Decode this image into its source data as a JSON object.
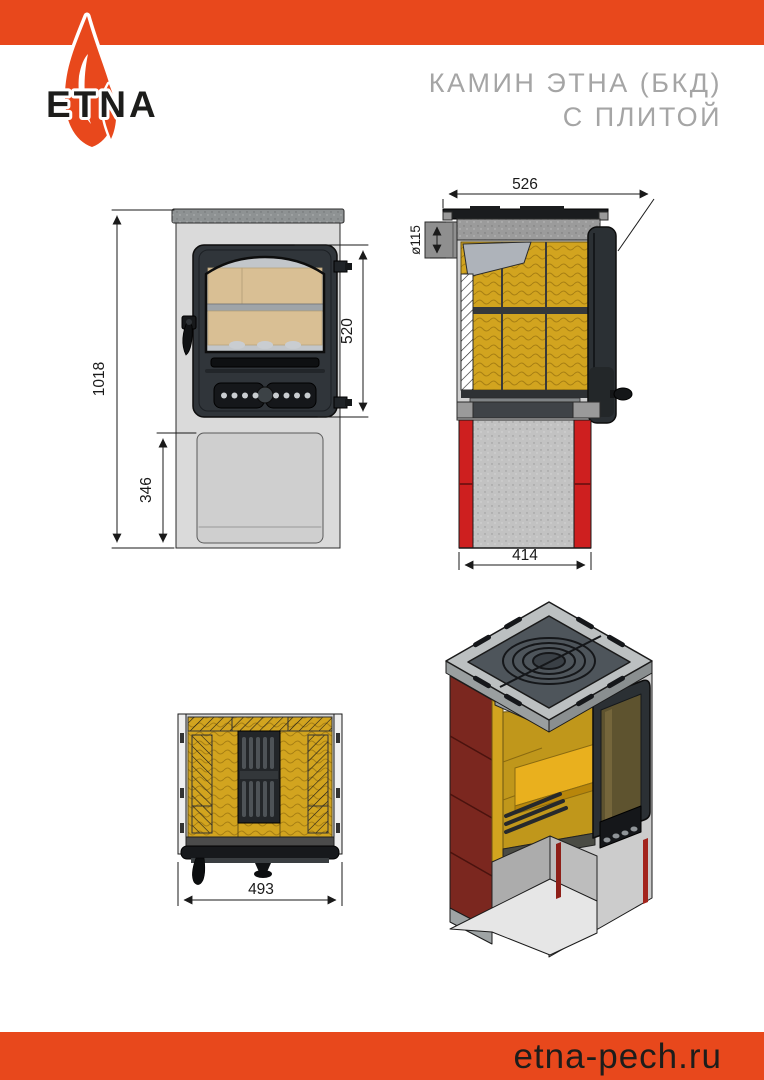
{
  "header": {
    "logo_text": "ETNA",
    "title_line1": "КАМИН ЭТНА (БКД)",
    "title_line2": "С ПЛИТОЙ"
  },
  "footer": {
    "website": "etna-pech.ru"
  },
  "colors": {
    "orange": "#E8481C",
    "red_panel": "#CE1F1F",
    "maroon_tile": "#7B271F",
    "vermiculite_yellow": "#D2A41F",
    "firebrick_tan": "#D9BF94",
    "door_dark": "#2F3438",
    "body_gray": "#D9D9D9",
    "title_gray": "#A5A5A5"
  },
  "views": {
    "front": {
      "label": "front-view",
      "dims": {
        "total_height": "1018",
        "base_height": "346",
        "door_height": "520"
      }
    },
    "side_section": {
      "label": "side-section-view",
      "dims": {
        "depth": "526",
        "flue_diameter": "ø115",
        "base_depth": "414"
      }
    },
    "top_section": {
      "label": "top-section-view",
      "dims": {
        "width": "493"
      }
    },
    "isometric": {
      "label": "isometric-cutaway-view"
    }
  }
}
